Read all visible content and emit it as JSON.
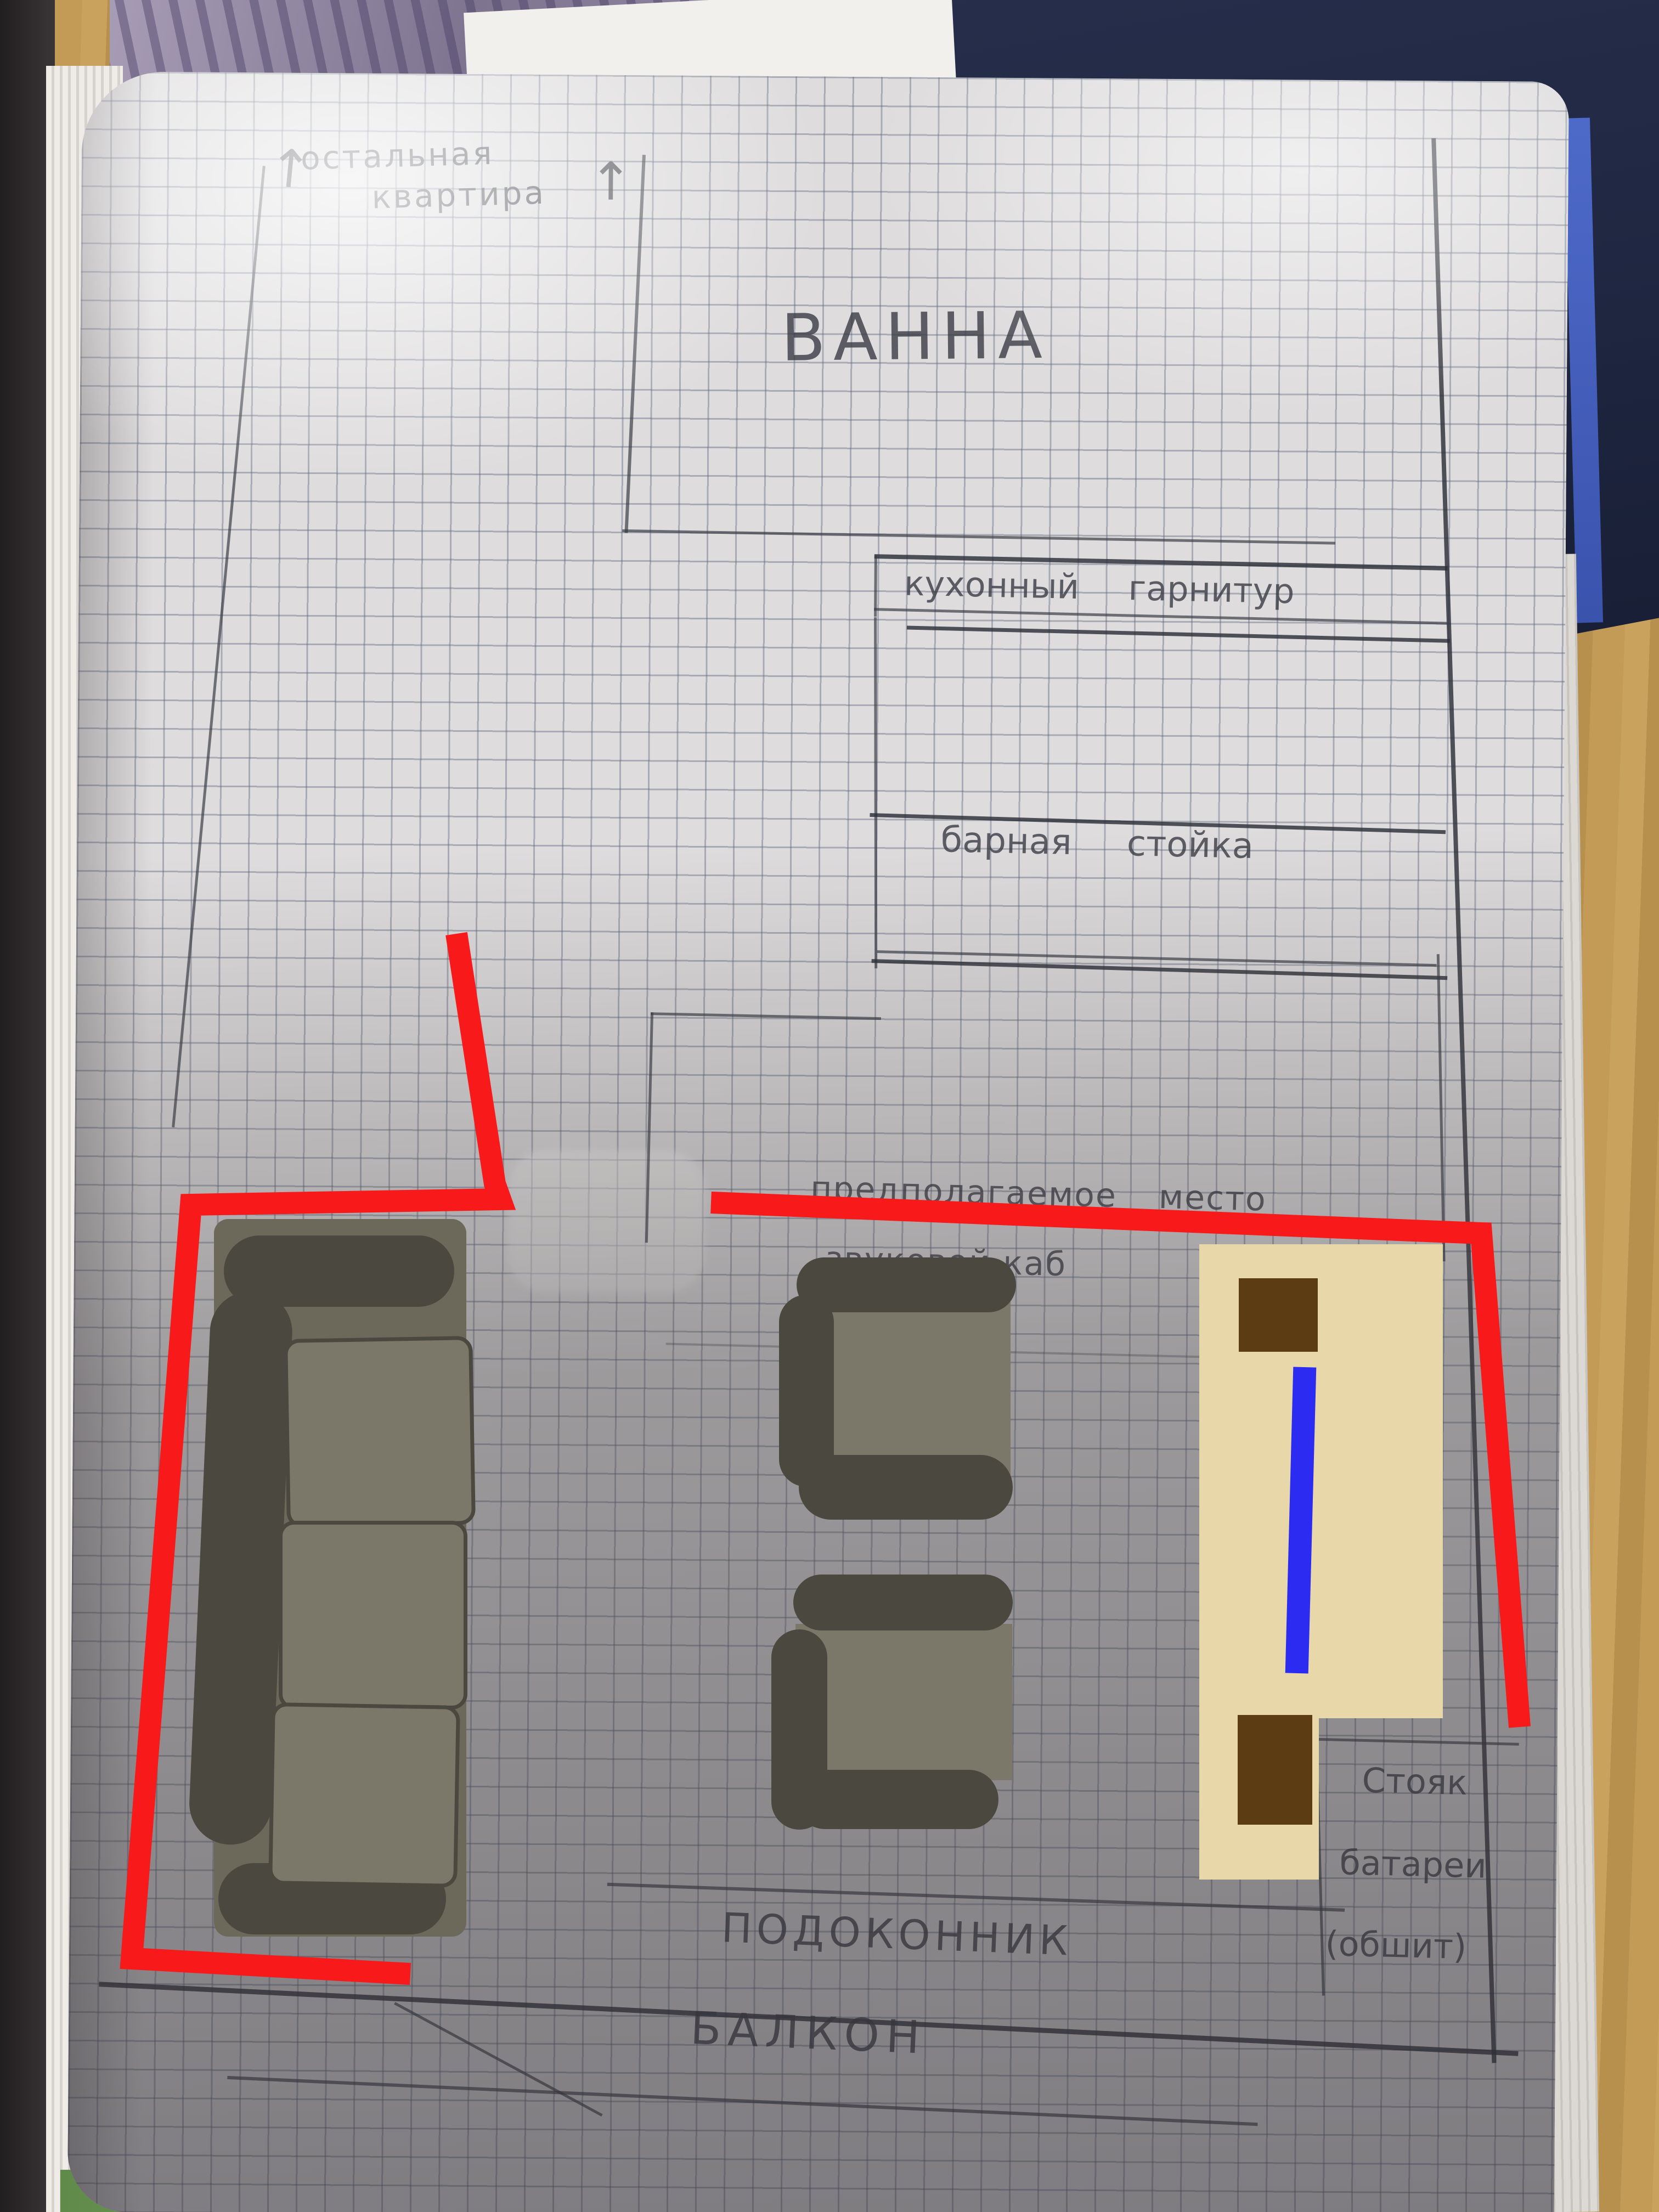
{
  "plan": {
    "rest_of_apartment_line1": "остальная",
    "rest_of_apartment_line2": "квартира",
    "up_arrow": "↑",
    "bath": "ВАННА",
    "kitchen_set": "кухонный гарнитур",
    "bar_counter": "барная стойка",
    "proposed_place_line1": "предполагаемое место",
    "proposed_place_line2": "звуковой каб",
    "windowsill": "ПОДОКОННИК",
    "balcony": "БАЛКОН",
    "riser_line1": "Стояк",
    "riser_line2": "батареи",
    "riser_line3": "(обшит)"
  },
  "colors": {
    "annotation_red": "#f8191b",
    "annotation_blue": "#2b2bf2",
    "table_beige": "#e8d7a8",
    "speaker_brown": "#5b3c13",
    "furniture_dark": "#4b4840",
    "furniture_light": "#7c7869",
    "sofa_base": "#6c685a"
  }
}
